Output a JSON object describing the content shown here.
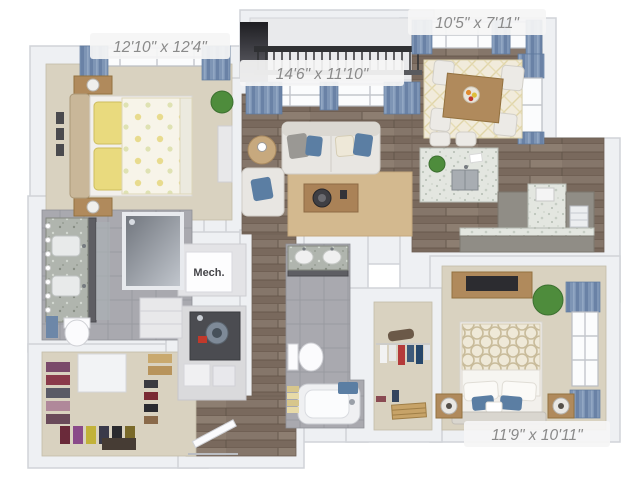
{
  "floorplan": {
    "rooms": [
      {
        "name": "master-bedroom",
        "label": "12'10\" x 12'4\""
      },
      {
        "name": "living-room",
        "label": "14'6\" x 11'10\""
      },
      {
        "name": "dining-area",
        "label": "10'5\" x 7'11\""
      },
      {
        "name": "bedroom-2",
        "label": "11'9\" x 10'11\""
      },
      {
        "name": "mechanical-room",
        "label": "Mech."
      }
    ],
    "colors": {
      "background": "#ffffff",
      "wall": "#eef0f3",
      "wall_edge": "#d0d3d8",
      "wood_floor": "#85766a",
      "carpet": "#d9d2c0",
      "tile": "#a9a9af",
      "curtain_blue": "#7e95b5",
      "rug_tan": "#d3b98f",
      "dining_rug": "#f1ebdb",
      "sofa": "#e8e6e2",
      "wood_furniture": "#b08a5c",
      "granite_light": "#e3e6e0",
      "granite_dark": "#b0b5ae",
      "cabinet_dark": "#5e5e63",
      "cabinet_taupe": "#908d86",
      "pillow_yellow": "#e9da7e",
      "pillow_blue": "#5b7ea3",
      "plant_green": "#4e8c3c",
      "railing_dark": "#2f3033",
      "label_text": "#8a8a8a",
      "label_bg": "#f5f5f5",
      "mech_text": "#46464a"
    }
  }
}
